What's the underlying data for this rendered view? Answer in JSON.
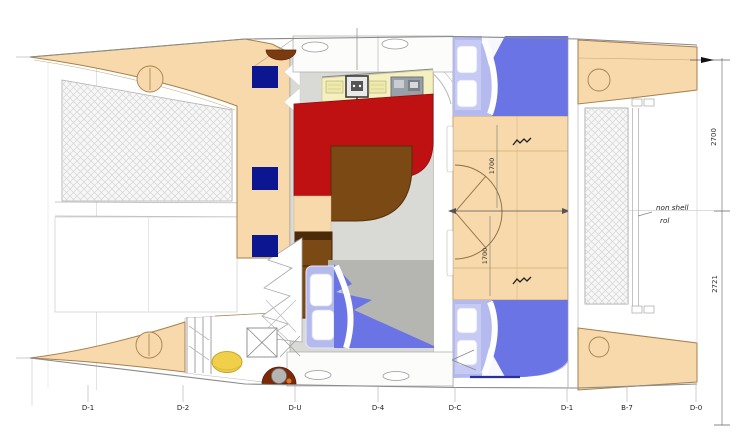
{
  "stations": [
    "D-1",
    "D-2",
    "D-U",
    "D-4",
    "D-C",
    "D-1",
    "B-7",
    "D-0"
  ],
  "dimensions": {
    "right_upper": "2700",
    "right_lower": "2721",
    "cabin_fore": "1700",
    "cabin_aft": "1700"
  },
  "note": {
    "line1": "non shell",
    "line2": "rol"
  },
  "colors": {
    "hull_deck": "#f7d9ab",
    "hull_outline": "#a6804e",
    "settee_red": "#bf1111",
    "table_brown": "#7b4913",
    "window_navy": "#0b1690",
    "duvet_blue": "#6a74e4",
    "mattress_blue": "#b4baee",
    "salon_floor_grey": "#d9d9d6",
    "counter_cream": "#f5f0c0",
    "fender_yellow": "#f0cf4a",
    "winch_mount_brown": "#7b2a0a"
  }
}
